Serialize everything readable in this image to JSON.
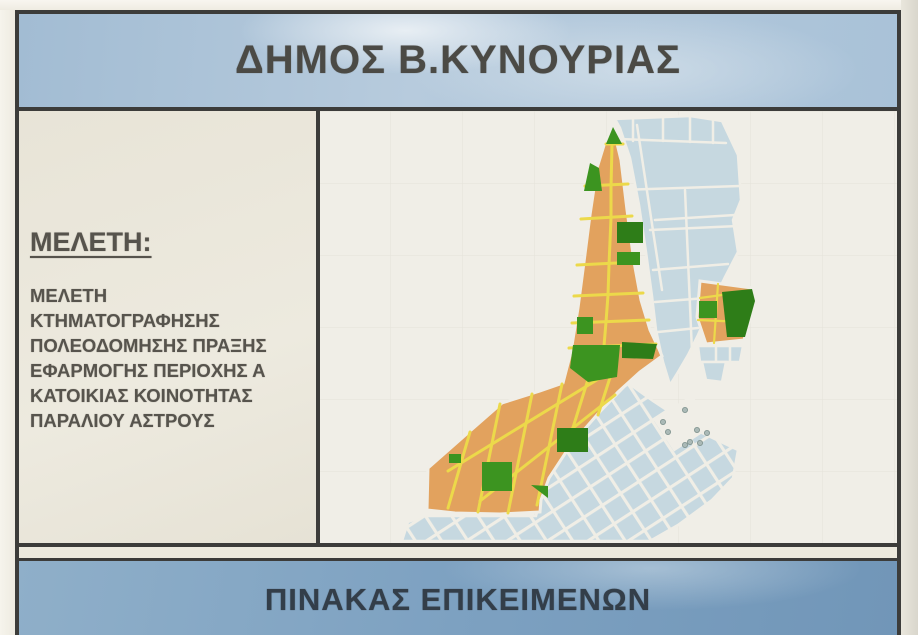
{
  "poster": {
    "title": "ΔΗΜΟΣ Β.ΚΥΝΟΥΡΙΑΣ",
    "study": {
      "heading": "ΜΕΛΕΤΗ:",
      "lines": [
        "ΜΕΛΕΤΗ",
        "ΚΤΗΜΑΤΟΓΡΑΦΗΣΗΣ",
        "ΠΟΛΕΟΔΟΜΗΣΗΣ ΠΡΑΞΗΣ",
        "ΕΦΑΡΜΟΓΗΣ ΠΕΡΙΟΧΗΣ Α",
        "ΚΑΤΟΙΚΙΑΣ ΚΟΙΝΟΤΗΤΑΣ",
        "ΠΑΡΑΛΙΟΥ ΑΣΤΡΟΥΣ"
      ]
    },
    "footer": "ΠΙΝΑΚΑΣ ΕΠΙΚΕΙΜΕΝΩΝ",
    "colors": {
      "title_band_blue": "#aec5d9",
      "footer_band_blue": "#7da1c1",
      "paper_cream": "#e9e5da",
      "map_background": "#f0eee7",
      "zone_orange": "#e2a25e",
      "zone_green": "#3c9420",
      "zone_green_dark": "#2e7d18",
      "blocks_blue": "#c6d8e0",
      "street_yellow": "#ecd94a",
      "street_white": "#f0eee6",
      "frame_dark": "#3c3c3a",
      "text_dark": "#4b4a45",
      "footer_text": "#333e49"
    }
  }
}
